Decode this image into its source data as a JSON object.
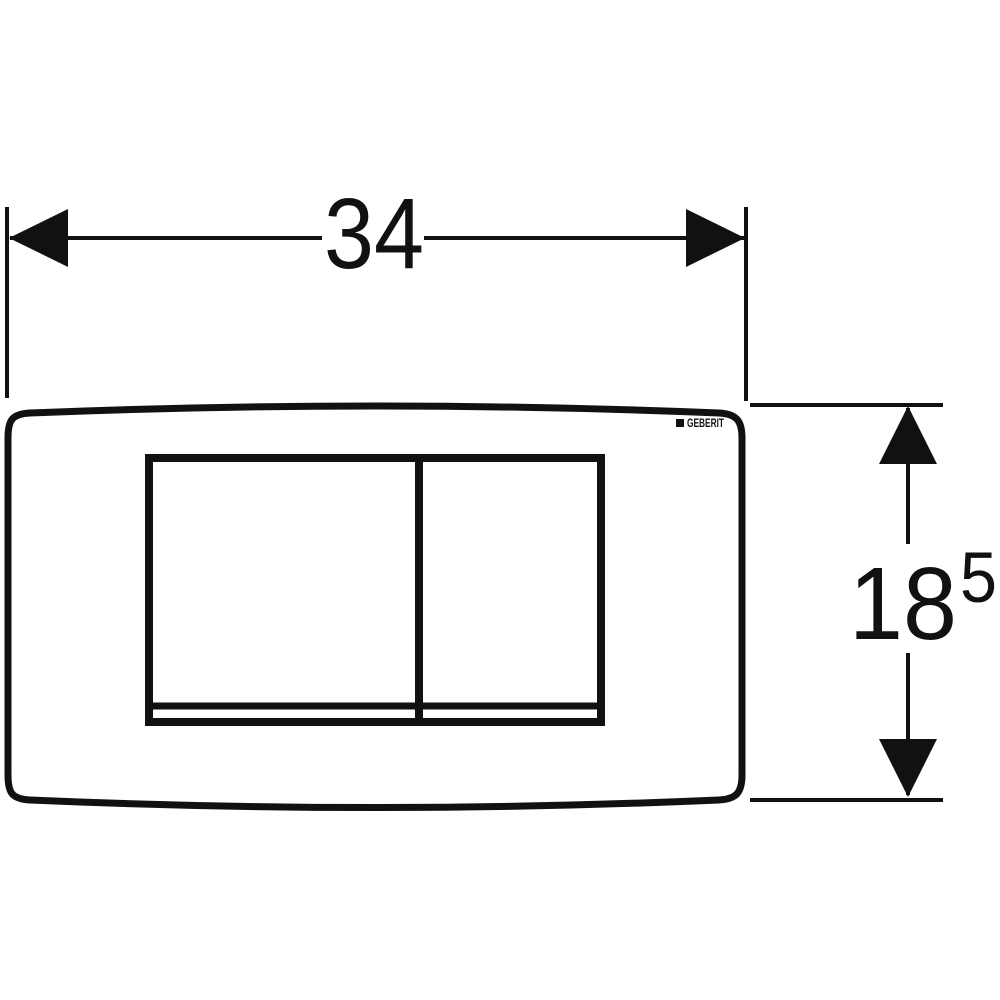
{
  "drawing": {
    "brand_logo": "GEBERIT",
    "width_dimension": {
      "label": "34"
    },
    "height_dimension": {
      "label": "18",
      "superscript": "5"
    },
    "colors": {
      "line": "#111111",
      "background": "#ffffff"
    }
  }
}
